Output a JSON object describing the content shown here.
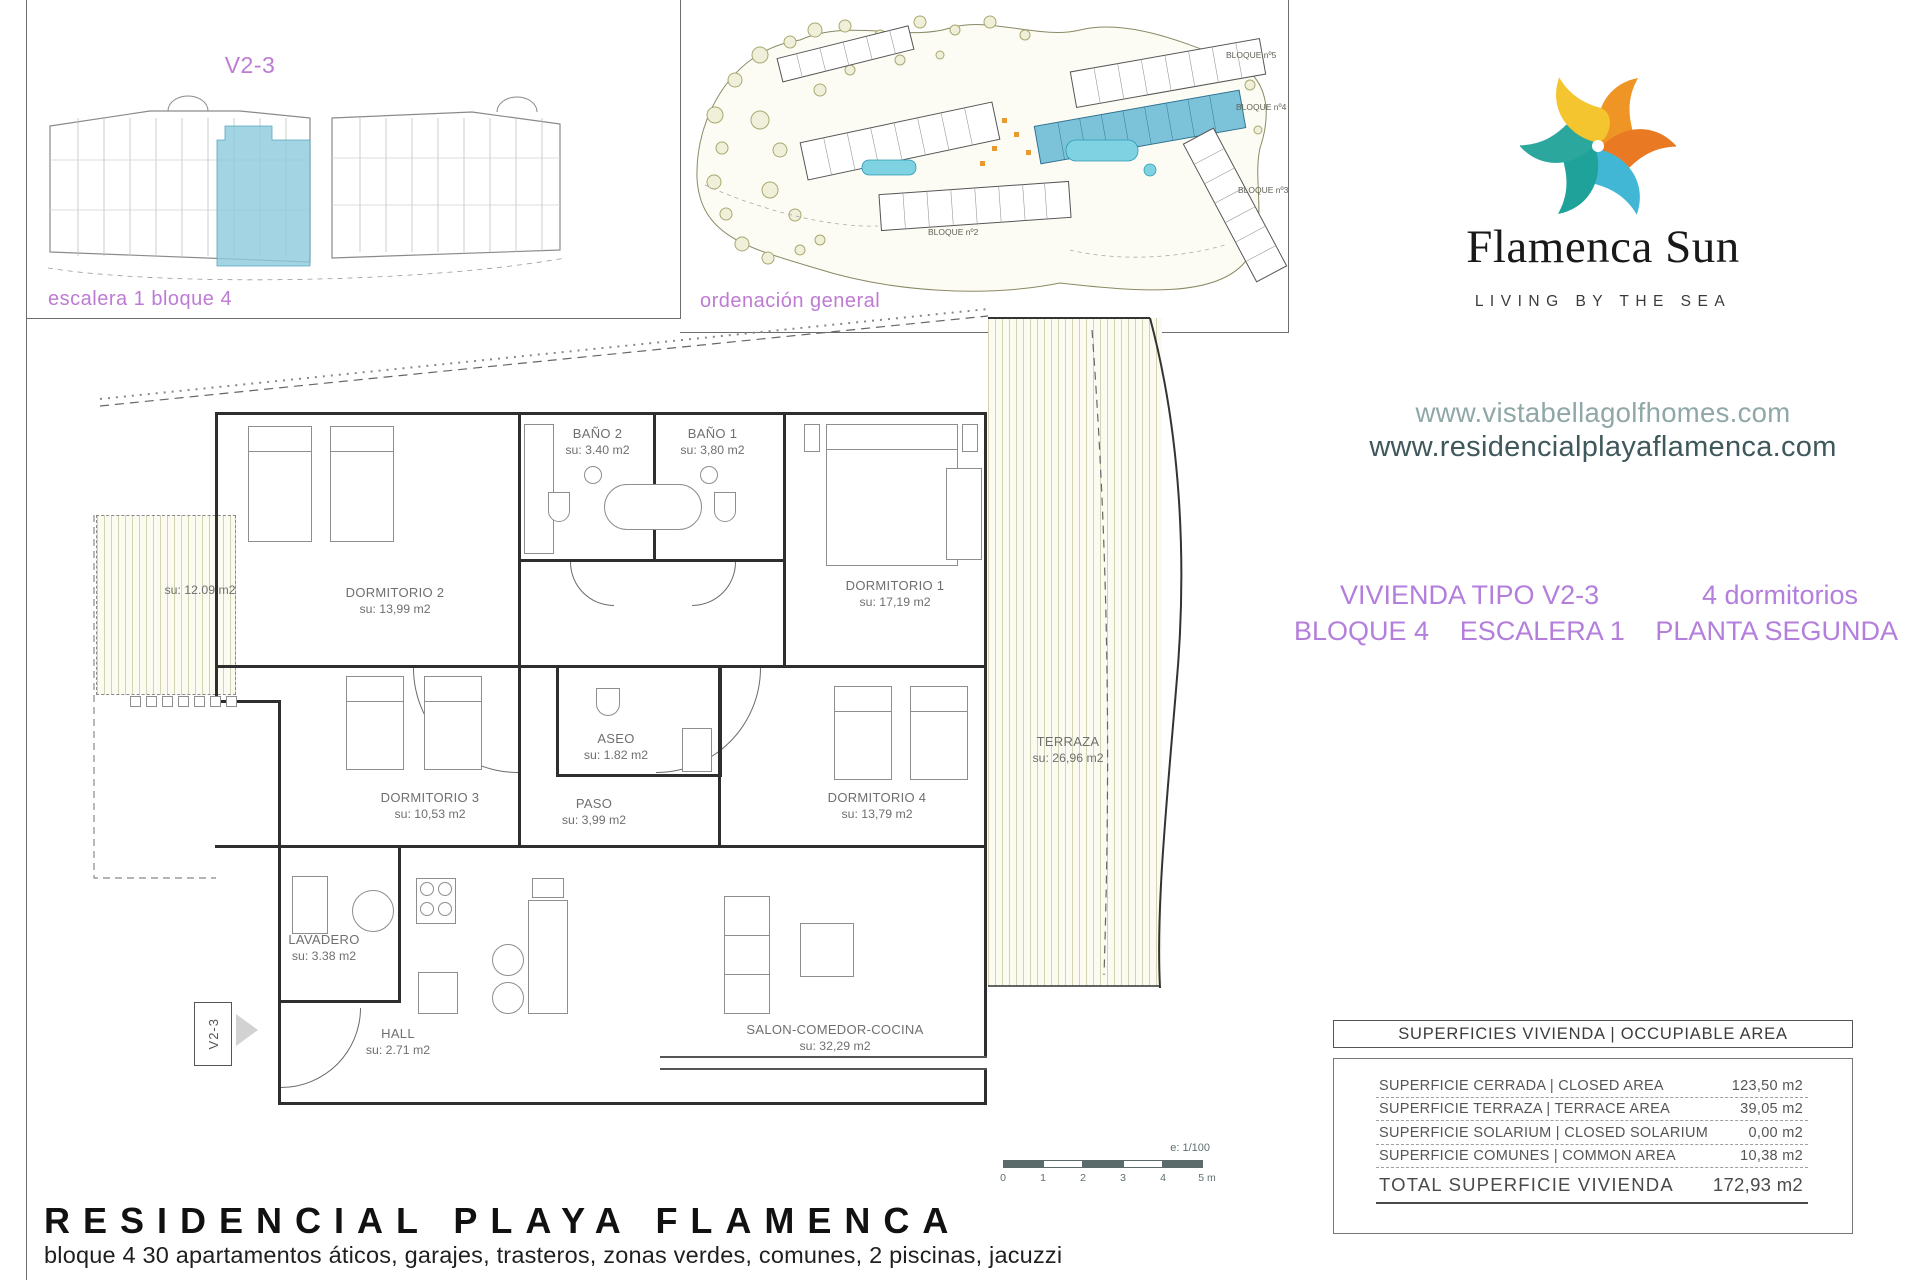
{
  "unit_locator": {
    "title": "V2-3",
    "caption": "escalera 1 bloque 4"
  },
  "site_plan": {
    "caption": "ordenación general",
    "blocks": [
      "BLOQUE nº5",
      "BLOQUE nº4",
      "BLOQUE nº3",
      "BLOQUE nº2"
    ]
  },
  "brand": {
    "name": "Flamenca Sun",
    "tagline": "LIVING BY THE SEA",
    "website_primary": "www.vistabellagolfhomes.com",
    "website_secondary": "www.residencialplayaflamenca.com"
  },
  "unit_info": {
    "type": "VIVIENDA TIPO V2-3",
    "bedrooms": "4 dormitorios",
    "block": "BLOQUE 4",
    "stair": "ESCALERA 1",
    "floor": "PLANTA SEGUNDA"
  },
  "floor_plan": {
    "entry_label": "V2-3",
    "rooms": [
      {
        "name": "BAÑO 2",
        "area": "su: 3.40 m2"
      },
      {
        "name": "BAÑO 1",
        "area": "su: 3,80 m2"
      },
      {
        "name": "DORMITORIO 2",
        "area": "su: 13,99 m2"
      },
      {
        "name": "DORMITORIO 1",
        "area": "su: 17,19 m2"
      },
      {
        "name": "",
        "area": "su: 12.09 m2"
      },
      {
        "name": "ASEO",
        "area": "su: 1.82 m2"
      },
      {
        "name": "DORMITORIO 3",
        "area": "su: 10,53 m2"
      },
      {
        "name": "PASO",
        "area": "su: 3,99 m2"
      },
      {
        "name": "DORMITORIO 4",
        "area": "su: 13,79 m2"
      },
      {
        "name": "TERRAZA",
        "area": "su: 26,96 m2"
      },
      {
        "name": "LAVADERO",
        "area": "su: 3.38 m2"
      },
      {
        "name": "HALL",
        "area": "su: 2.71 m2"
      },
      {
        "name": "SALON-COMEDOR-COCINA",
        "area": "su: 32,29 m2"
      }
    ]
  },
  "scale_bar": {
    "ratio": "e: 1/100",
    "ticks": [
      "0",
      "1",
      "2",
      "3",
      "4",
      "5 m"
    ]
  },
  "areas_table": {
    "header": "SUPERFICIES VIVIENDA | OCCUPIABLE AREA",
    "rows": [
      {
        "label": "SUPERFICIE CERRADA | CLOSED AREA",
        "value": "123,50 m2"
      },
      {
        "label": "SUPERFICIE TERRAZA | TERRACE AREA",
        "value": "39,05 m2"
      },
      {
        "label": "SUPERFICIE SOLARIUM | CLOSED SOLARIUM",
        "value": "0,00 m2"
      },
      {
        "label": "SUPERFICIE COMUNES | COMMON AREA",
        "value": "10,38 m2"
      }
    ],
    "total": {
      "label": "TOTAL SUPERFICIE VIVIENDA",
      "value": "172,93 m2"
    }
  },
  "footer": {
    "title": "RESIDENCIAL PLAYA FLAMENCA",
    "subtitle": "bloque 4 30 apartamentos áticos, garajes, trasteros, zonas verdes, comunes, 2 piscinas, jacuzzi"
  },
  "colors": {
    "accent_purple": "#BC7BD4",
    "highlight_cyan": "#8FCBDD",
    "logo_yellow": "#F5C52F",
    "logo_orange": "#EE9526",
    "logo_orange_deep": "#E97A23",
    "logo_blue": "#41B7D5",
    "logo_teal": "#1EA29A",
    "website_muted": "#8FA7A7",
    "website_dark": "#3F585B"
  }
}
